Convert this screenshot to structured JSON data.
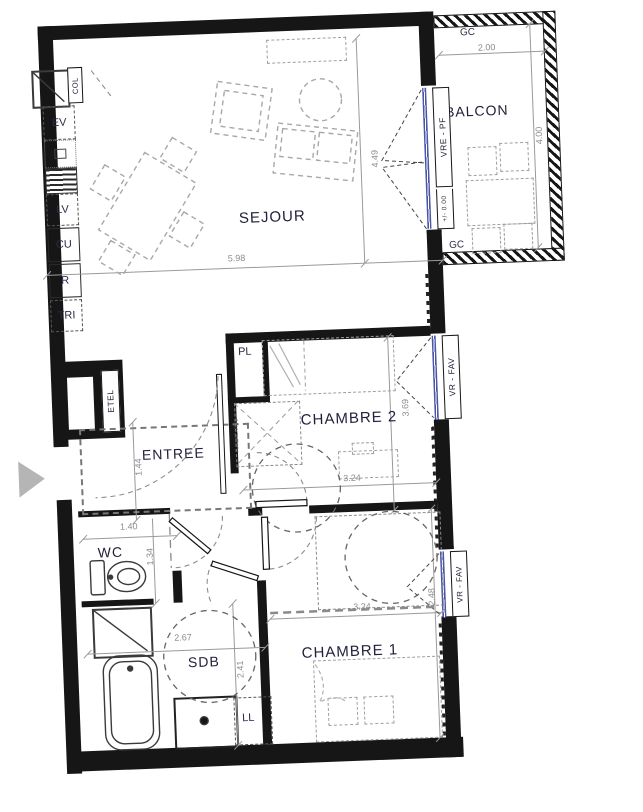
{
  "rooms": {
    "sejour": "SEJOUR",
    "balcon": "BALCON",
    "chambre2": "CHAMBRE 2",
    "chambre1": "CHAMBRE 1",
    "entree": "ENTREE",
    "wc": "WC",
    "sdb": "SDB"
  },
  "kitchen": {
    "col": "COL",
    "ev": "EV",
    "lv": "LV",
    "cu": "CU",
    "r": "R",
    "tri": "TRI"
  },
  "storage": {
    "pl": "PL",
    "etel": "ETEL",
    "ll": "LL",
    "note": "R. PLACARDS"
  },
  "balcony": {
    "gc_top": "GC",
    "gc_bottom": "GC"
  },
  "windows": {
    "sejour_label": "VRE - PF",
    "chambre2_label": "VR - FAV",
    "chambre1_label": "VR - FAV",
    "level": "+/- 0.00"
  },
  "dims": {
    "sejour_w": "5.98",
    "sejour_h": "4.49",
    "balcon_w": "2.00",
    "balcon_h": "4.00",
    "chambre2_w": "3.24",
    "chambre2_h": "3.69",
    "entree_h": "1.44",
    "wc_w": "1.40",
    "wc_h": "1.34",
    "sdb_w": "2.67",
    "sdb_h": "2.41",
    "chambre1_w": "3.24",
    "chambre1_h": "2.48"
  },
  "colors": {
    "wall": "#161616",
    "glazing": "#4a55a8",
    "furniture": "#9f9f9f",
    "dim_text": "#8c8c8c",
    "room_text": "#21213b"
  }
}
